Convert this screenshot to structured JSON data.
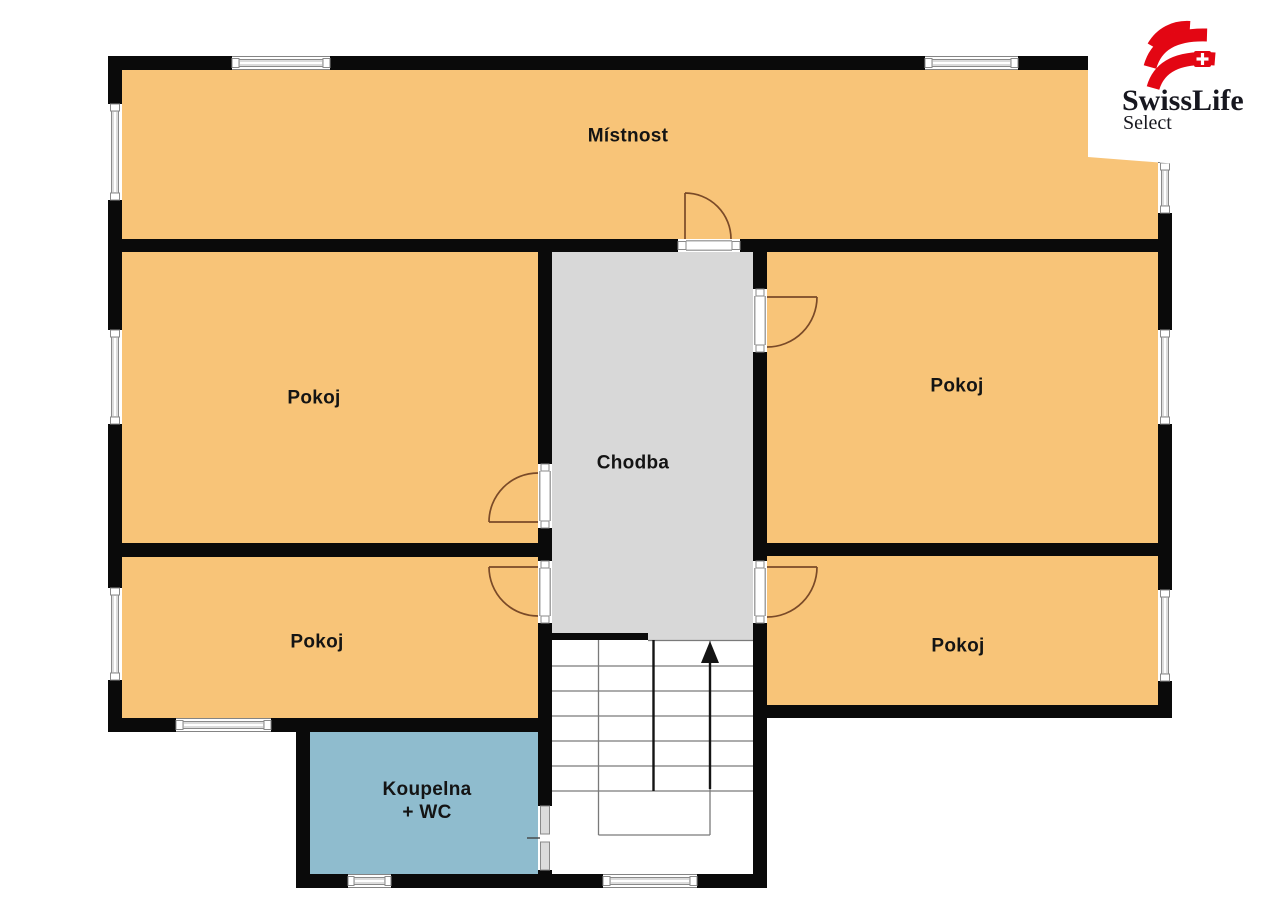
{
  "plan_type": "floor-plan",
  "rooms": {
    "mistnost": {
      "label": "Místnost",
      "color": "#F8C478"
    },
    "pokoj_mid_left": {
      "label": "Pokoj",
      "color": "#F8C478"
    },
    "pokoj_mid_right": {
      "label": "Pokoj",
      "color": "#F8C478"
    },
    "pokoj_bottom_left": {
      "label": "Pokoj",
      "color": "#F8C478"
    },
    "pokoj_bottom_right": {
      "label": "Pokoj",
      "color": "#F8C478"
    },
    "chodba": {
      "label": "Chodba",
      "color": "#D8D8D8"
    },
    "koupelna": {
      "label_line1": "Koupelna",
      "label_line2": "+ WC",
      "color": "#8FBCCE"
    },
    "stairs": {
      "direction": "up"
    }
  },
  "logo": {
    "brand": "SwissLife",
    "subbrand": "Select",
    "brand_red": "#E30613"
  },
  "colors": {
    "wall": "#0A0A0A",
    "room_fill": "#F8C478",
    "hallway_fill": "#D8D8D8",
    "bathroom_fill": "#8FBCCE",
    "stairs_fill": "#FFFFFF",
    "door_arc": "#7A4A28",
    "window_line": "#8A8A8A",
    "background": "#FFFFFF"
  }
}
